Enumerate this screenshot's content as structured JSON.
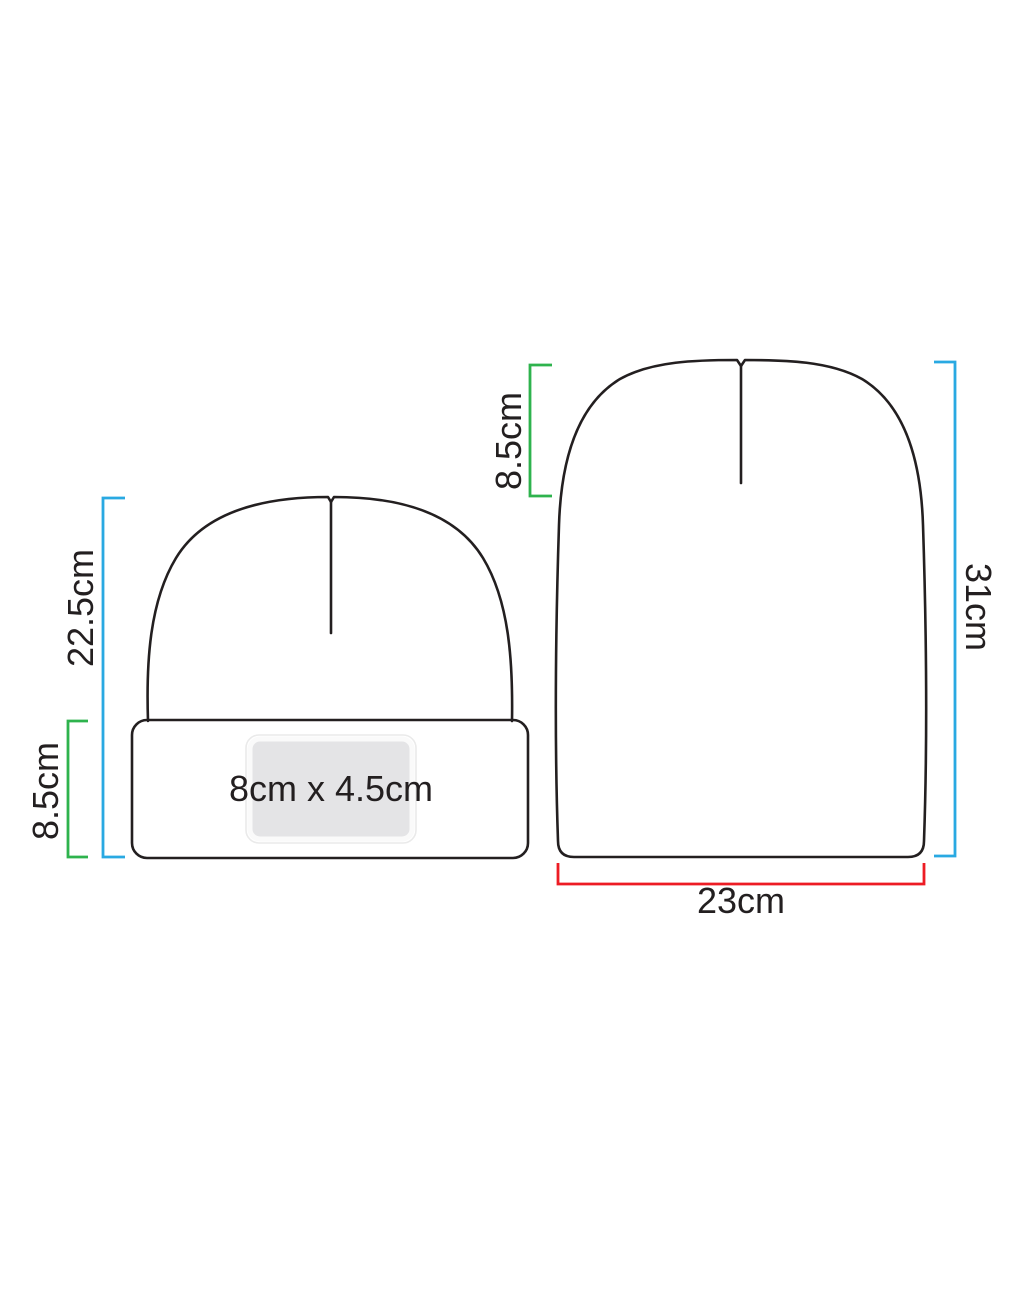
{
  "colors": {
    "background": "#ffffff",
    "outline": "#231f20",
    "text": "#231f20",
    "bracket-blue": "#29a9e2",
    "bracket-green": "#2eb34d",
    "bracket-red": "#ed1c24",
    "label-fill": "#e4e4e6",
    "label-border": "#fafafa",
    "label-outer-line": "#eaeaea"
  },
  "cuffed_beanie": {
    "height_label": "22.5cm",
    "cuff_height_label": "8.5cm",
    "print_area_label": "8cm x 4.5cm"
  },
  "uncuffed_beanie": {
    "crown_depth_label": "8.5cm",
    "height_label": "31cm",
    "width_label": "23cm"
  }
}
